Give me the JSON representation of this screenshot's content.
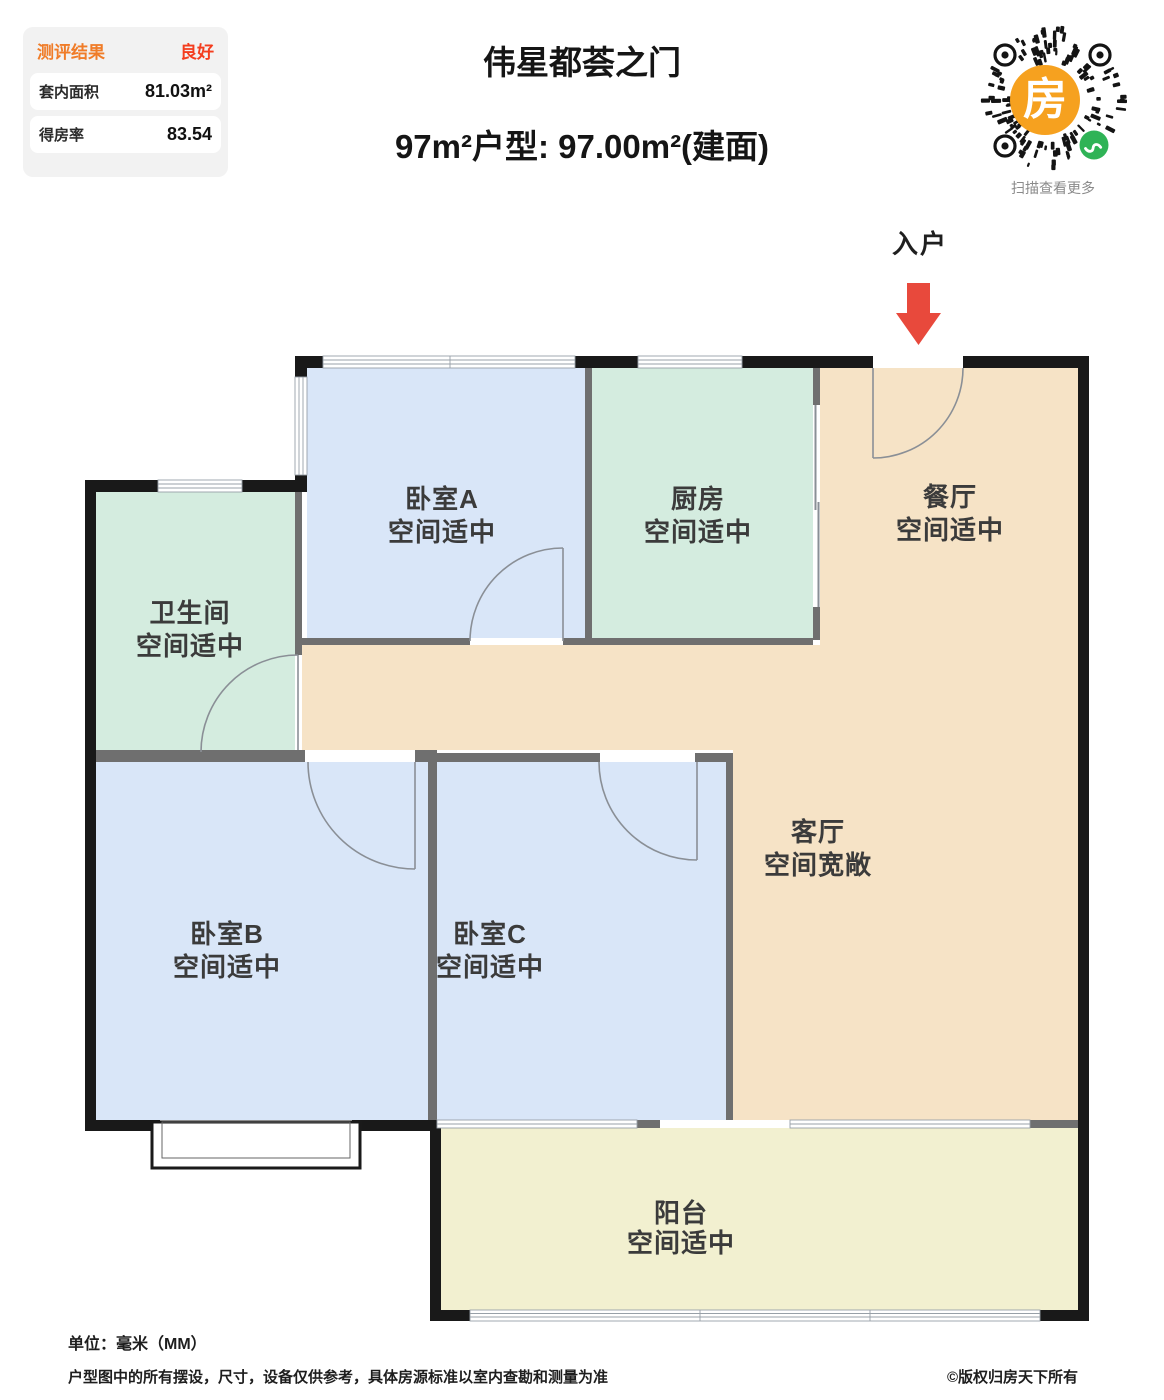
{
  "evaluation_panel": {
    "header_label": "测评结果",
    "header_value": "良好",
    "rows": [
      {
        "label": "套内面积",
        "value": "81.03m²"
      },
      {
        "label": "得房率",
        "value": "83.54"
      }
    ]
  },
  "header": {
    "project_title": "伟星都荟之门",
    "layout_subtitle": "97m²户型: 97.00m²(建面)"
  },
  "qr": {
    "center_glyph": "房",
    "caption": "扫描查看更多"
  },
  "plan": {
    "entry_label": "入户",
    "rooms": {
      "bedroomA": {
        "name": "卧室A",
        "status": "空间适中"
      },
      "kitchen": {
        "name": "厨房",
        "status": "空间适中"
      },
      "dining": {
        "name": "餐厅",
        "status": "空间适中"
      },
      "bathroom": {
        "name": "卫生间",
        "status": "空间适中"
      },
      "living": {
        "name": "客厅",
        "status": "空间宽敞"
      },
      "bedroomB": {
        "name": "卧室B",
        "status": "空间适中"
      },
      "bedroomC": {
        "name": "卧室C",
        "status": "空间适中"
      },
      "balcony": {
        "name": "阳台",
        "status": "空间适中"
      }
    }
  },
  "footer": {
    "unit": "单位：毫米（MM）",
    "disclaimer": "户型图中的所有摆设，尺寸，设备仅供参考，具体房源标准以室内查勘和测量为准",
    "copyright": "©版权归房天下所有"
  },
  "colors": {
    "accent_orange": "#f07c28",
    "rating_red": "#f43d1e",
    "arrow_red": "#e8493c",
    "qr_orange": "#f6a11f",
    "qr_green": "#2fb356",
    "floor_blue": "#d9e6f8",
    "floor_green": "#d4ecdf",
    "floor_tan": "#f6e3c6",
    "floor_yellow": "#f2f0d0",
    "wall_black": "#191919",
    "wall_gray": "#6f6f6f"
  }
}
